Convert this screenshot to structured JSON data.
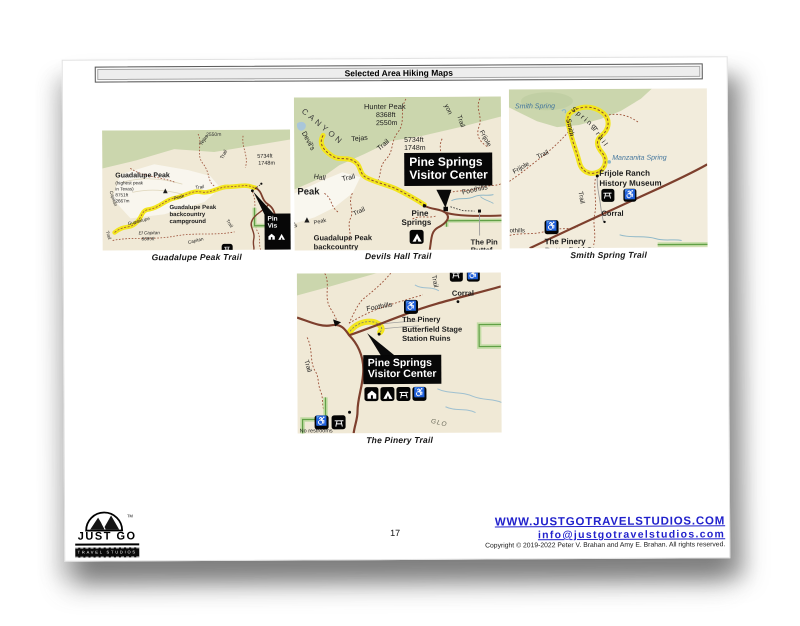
{
  "header": {
    "title": "Selected Area Hiking Maps"
  },
  "page_number": "17",
  "footer": {
    "logo": {
      "brand": "JUST GO",
      "tagline": "TRAVEL STUDIOS",
      "trademark": "TM"
    },
    "website": "WWW.JUSTGOTRAVELSTUDIOS.COM",
    "email": "info@justgotravelstudios.com",
    "copyright": "Copyright © 2019-2022 Peter V. Brahan and Amy E. Brahan.  All rights reserved."
  },
  "icons": {
    "wheelchair_glyph": "♿",
    "campsite_glyph": "▲"
  },
  "colors": {
    "link_blue": "#2121cc",
    "highlight_yellow": "#f2e51f",
    "map_green": "#cbd6ad",
    "map_tan": "#f0e9d6",
    "road_brown": "#7d3f2d",
    "boundary_green": "#61a046",
    "spring_blue": "#41749c"
  },
  "maps": {
    "guadalupe": {
      "caption": "Guadalupe Peak Trail",
      "labels": {
        "elev_2550": "2550m",
        "tejas": "Tejas",
        "tejas_trail": "Trail",
        "elev_5734": "5734ft",
        "elev_1748": "1748m",
        "peak_name": "Guadalupe Peak",
        "peak_note1": "(highest peak",
        "peak_note2": "in Texas)",
        "peak_ft": "8751ft",
        "peak_m": "2667m",
        "camp1": "Guadalupe Peak",
        "camp2": "backcountry",
        "camp3": "campground",
        "trail_guadalupe": "Guadalupe",
        "trail_peak": "Peak",
        "trail_trail": "Trail",
        "el_capitan": "El Capitan",
        "el_capitan_ft": "8085ft",
        "capitan_right": "Capitan",
        "trail_right": "Trail",
        "capitan_left": "Capitan",
        "trail_left": "Trail",
        "vc1": "Pin",
        "vc2": "Vis"
      }
    },
    "devils": {
      "caption": "Devils Hall Trail",
      "labels": {
        "canyon": "CANYON",
        "hunter": "Hunter Peak",
        "hunter_ft": "8368ft",
        "hunter_m": "2550m",
        "tejas": "Tejas",
        "tejas_trail": "Trail",
        "elev_5734": "5734ft",
        "elev_1748": "1748m",
        "yon": "yon",
        "yon_trail": "Trail",
        "frijole": "Frijole",
        "devils": "Devil's",
        "hall": "Hall",
        "hall_trail": "Trail",
        "peak": "Peak",
        "trail_small": "Trail",
        "pine": "Pine",
        "springs": "Springs",
        "foothills": "Foothills",
        "peak_small": "Peak",
        "pe": "pe",
        "gp1": "Guadalupe Peak",
        "gp2": "backcountry",
        "pinery1": "The Pin",
        "pinery2": "Buttef",
        "vc1": "Pine Springs",
        "vc2": "Visitor Center"
      }
    },
    "smith": {
      "caption": "Smith Spring Trail",
      "labels": {
        "smith_spring": "Smith Spring",
        "spring": "Spring",
        "spring_trail": "Trail",
        "smith": "Smith",
        "frijole": "Frijole",
        "frijole_trail": "Trail",
        "manzanita": "Manzanita Spring",
        "ranch1": "Frijole Ranch",
        "ranch2": "History Museum",
        "corral": "Corral",
        "trail_v": "Trail",
        "foothills": "othills",
        "pinery1": "The Pinery",
        "pinery2": "Butterfield Stage"
      }
    },
    "pinery": {
      "caption": "The Pinery Trail",
      "labels": {
        "trail_top": "Trail",
        "corral": "Corral",
        "foothills": "Foothills",
        "pin1": "The Pinery",
        "pin2": "Butterfield Stage",
        "pin3": "Station Ruins",
        "trail_left": "Trail",
        "no_restrooms": "No restrooms",
        "glo": "GLO",
        "vc1": "Pine Springs",
        "vc2": "Visitor Center"
      }
    }
  }
}
